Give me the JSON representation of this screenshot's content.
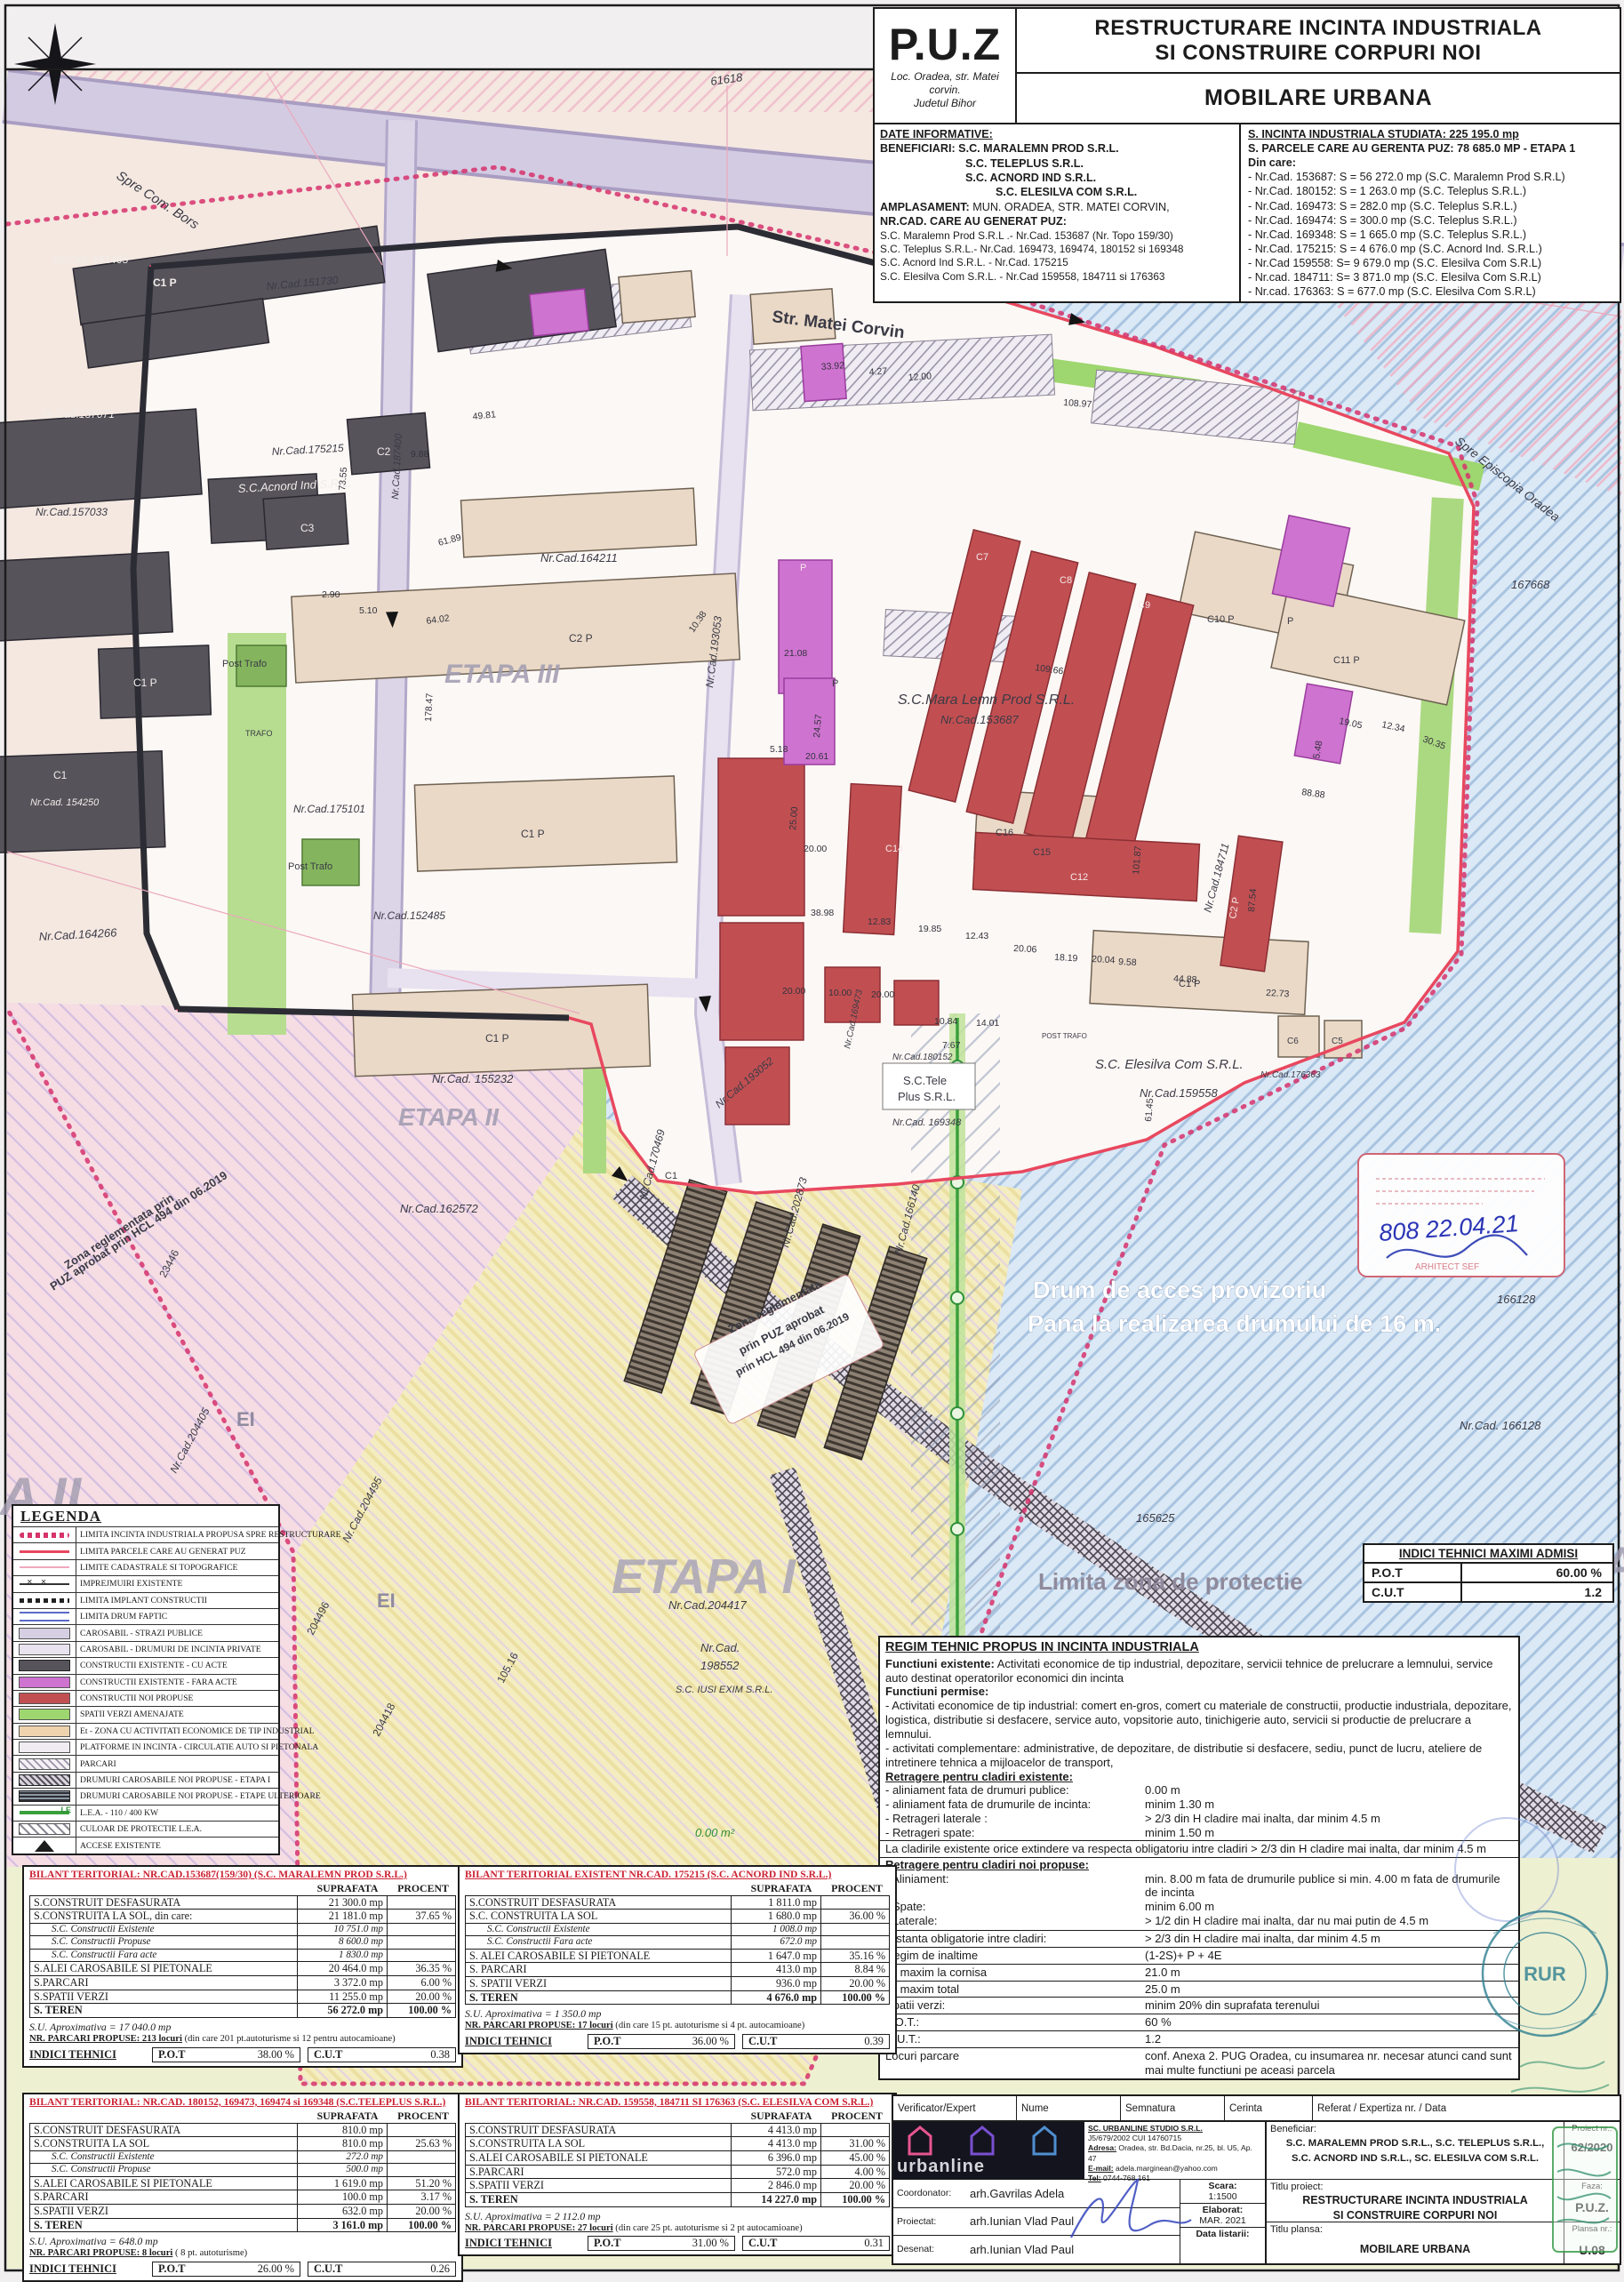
{
  "header": {
    "puz": "P.U.Z",
    "loc1": "Loc. Oradea, str. Matei corvin.",
    "loc2": "Judetul Bihor",
    "title1": "RESTRUCTURARE INCINTA INDUSTRIALA",
    "title2": "SI CONSTRUIRE CORPURI NOI",
    "subtitle": "MOBILARE URBANA",
    "di_label": "DATE INFORMATIVE:",
    "ben_label": "BENEFICIARI:",
    "ben1": "S.C. MARALEMN PROD S.R.L.",
    "ben2": "S.C. TELEPLUS S.R.L.",
    "ben3": "S.C. ACNORD IND S.R.L.",
    "ben4": "S.C. ELESILVA COM S.R.L.",
    "ampl_label": "AMPLASAMENT:",
    "ampl": " MUN. ORADEA, STR. MATEI CORVIN,",
    "nrcad_label": "NR.CAD. CARE AU GENERAT PUZ:",
    "cad1": "S.C. Maralemn Prod S.R.L .- Nr.Cad. 153687 (Nr. Topo 159/30)",
    "cad2": "S.C. Teleplus S.R.L.- Nr.Cad. 169473, 169474, 180152 si 169348",
    "cad3": "S.C. Acnord Ind S.R.L. - Nr.Cad. 175215",
    "cad4": "S.C. Elesilva Com S.R.L. - Nr.Cad  159558, 184711 si 176363",
    "s1": "S. INCINTA INDUSTRIALA STUDIATA: 225 195.0 mp",
    "s2": "S. PARCELE CARE AU GERENTA PUZ: 78 685.0 MP - ETAPA 1",
    "s3": "Din care:",
    "slines": [
      "- Nr.Cad. 153687: S = 56 272.0 mp (S.C. Maralemn Prod S.R.L)",
      "- Nr.Cad. 180152: S =  1 263.0 mp (S.C. Teleplus S.R.L.)",
      "- Nr.Cad. 169473: S =     282.0 mp (S.C. Teleplus S.R.L.)",
      "- Nr.Cad. 169474: S =     300.0 mp (S.C. Teleplus S.R.L.)",
      "- Nr.Cad. 169348: S =  1 665.0 mp (S.C. Teleplus S.R.L.)",
      "- Nr.Cad. 175215: S =  4 676.0 mp (S.C. Acnord Ind. S.R.L.)",
      "- Nr.Cad  159558:  S=  9 679.0 mp (S.C. Elesilva Com S.R.L)",
      "- Nr.cad.  184711:  S=  3 871.0 mp (S.C. Elesilva Com S.R.L)",
      "- Nr.cad.  176363:  S =    677.0 mp (S.C. Elesilva Com S.R.L)"
    ]
  },
  "legend": {
    "title": "LEGENDA",
    "items": [
      "LIMITA INCINTA INDUSTRIALA PROPUSA SPRE RESTRUCTURARE",
      "LIMITA PARCELE CARE AU GENERAT PUZ",
      "LIMITE CADASTRALE SI TOPOGRAFICE",
      "IMPREJMUIRI EXISTENTE",
      "LIMITA IMPLANT CONSTRUCTII",
      "LIMITA DRUM FAPTIC",
      "CAROSABIL - STRAZI PUBLICE",
      "CAROSABIL - DRUMURI DE INCINTA PRIVATE",
      "CONSTRUCTII EXISTENTE - CU ACTE",
      "CONSTRUCTII EXISTENTE - FARA ACTE",
      "CONSTRUCTII NOI PROPUSE",
      "SPATII VERZI AMENAJATE",
      "Et - ZONA CU ACTIVITATI ECONOMICE DE TIP INDUSTRIAL",
      "PLATFORME IN INCINTA - CIRCULATIE AUTO SI PIETONALA",
      "PARCARI",
      "DRUMURI CAROSABILE NOI PROPUSE - ETAPA I",
      "DRUMURI CAROSABILE NOI PROPUSE - ETAPE ULTERIOARE",
      "L.E.A. - 110 / 400 KW",
      "CULOAR DE PROTECTIE L.E.A.",
      "ACCESE EXISTENTE"
    ]
  },
  "indici_maximi": {
    "title": "INDICI TEHNICI MAXIMI ADMISI",
    "pot_label": "P.O.T",
    "pot": "60.00 %",
    "cut_label": "C.U.T",
    "cut": "1.2"
  },
  "regim": {
    "title": "REGIM TEHNIC PROPUS IN INCINTA INDUSTRIALA",
    "fe_bold": "Functiuni existente:",
    "fe_text": " Activitati economice de tip industrial, depozitare, servicii tehnice de prelucrare a lemnului, service auto destinat operatorilor economici din incinta",
    "fp": "Functiuni permise:",
    "b1": "- Activitati economice de tip industrial: comert en-gros, comert cu materiale de constructii, productie industriala, depozitare, logistica, distributie si desfacere, service auto, vopsitorie auto, tinichigerie auto, servicii  si productie de prelucrare a lemnului.",
    "b2": "- activitati complementare: administrative, de depozitare, de distributie si desfacere, sediu, punct de lucru, ateliere de intretinere tehnica a mijloacelor de transport,",
    "re_head": "Retragere pentru cladiri existente:",
    "re_rows": [
      {
        "l": "- aliniament fata de drumuri publice:",
        "v": "0.00 m"
      },
      {
        "l": "- aliniament fata de drumurile de incinta:",
        "v": "minim 1.30 m"
      },
      {
        "l": "- Retrageri laterale :",
        "v": "> 2/3 din H cladire mai inalta, dar minim 4.5 m"
      },
      {
        "l": "- Retrageri spate:",
        "v": "minim 1.50 m"
      }
    ],
    "extindere": "La cladirile existente orice extindere va respecta obligatoriu intre cladiri > 2/3 din H cladire mai inalta, dar minim 4.5 m",
    "rn_head": "Retragere pentru cladiri noi propuse:",
    "rn_rows": [
      {
        "l": "- Aliniament:",
        "v": "min. 8.00 m fata de drumurile publice si min. 4.00 m fata de drumurile de incinta"
      },
      {
        "l": "- Spate:",
        "v": "minim 6.00 m"
      },
      {
        "l": "- Laterale:",
        "v": "> 1/2 din H cladire mai inalta, dar nu mai putin de 4.5 m"
      }
    ],
    "table_rows": [
      {
        "l": "Distanta obligatorie intre cladiri:",
        "v": "> 2/3 din H cladire mai inalta, dar minim 4.5 m"
      },
      {
        "l": "Regim de inaltime",
        "v": "(1-2S)+ P + 4E"
      },
      {
        "l": "H. maxim la cornisa",
        "v": "21.0 m"
      },
      {
        "l": "H. maxim total",
        "v": "25.0 m"
      },
      {
        "l": "Spatii verzi:",
        "v": "minim 20% din suprafata terenului"
      },
      {
        "l": "P.O.T.:",
        "v": "60 %"
      },
      {
        "l": "C.U.T.:",
        "v": "1.2"
      },
      {
        "l": "Locuri parcare",
        "v": "conf. Anexa 2. PUG Oradea, cu insumarea nr. necesar atunci cand sunt mai multe functiuni pe aceasi parcela"
      }
    ]
  },
  "b1": {
    "title": "BILANT TERITORIAL: NR.CAD.153687(159/30) (S.C. MARALEMN PROD S.R.L.)",
    "col_s": "SUPRAFATA",
    "col_p": "PROCENT",
    "rows": [
      {
        "l": "S.CONSTRUIT DESFASURATA",
        "s": "21 300.0 mp",
        "p": ""
      },
      {
        "l": "S.CONSTRUITA LA SOL, din care:",
        "s": "21 181.0 mp",
        "p": "37.65 %"
      },
      {
        "l": "S.C. Constructii Existente",
        "s": "10 751.0 mp",
        "p": ""
      },
      {
        "l": "S.C. Constructii Propuse",
        "s": "8 600.0 mp",
        "p": ""
      },
      {
        "l": "S.C. Constructii Fara acte",
        "s": "1 830.0 mp",
        "p": ""
      },
      {
        "l": "S.ALEI CAROSABILE SI PIETONALE",
        "s": "20 464.0 mp",
        "p": "36.35 %"
      },
      {
        "l": "S.PARCARI",
        "s": "3 372.0 mp",
        "p": "6.00 %"
      },
      {
        "l": "S.SPATII VERZI",
        "s": "11 255.0 mp",
        "p": "20.00 %"
      },
      {
        "l": "S. TEREN",
        "s": "56 272.0 mp",
        "p": "100.00 %"
      }
    ],
    "su": "S.U. Aproximativa = 17 040.0 mp",
    "parc_b": "NR. PARCARI PROPUSE: 213 locuri",
    "parc_r": " (din care 201 pt.autoturisme si 12 pentru autocamioane)",
    "ind": "INDICI TEHNICI",
    "potl": "P.O.T",
    "pot": "38.00 %",
    "cutl": "C.U.T",
    "cut": "0.38"
  },
  "b2": {
    "title": "BILANT TERITORIAL EXISTENT NR.CAD. 175215 (S.C. ACNORD IND S.R.L.)",
    "col_s": "SUPRAFATA",
    "col_p": "PROCENT",
    "rows": [
      {
        "l": "S.CONSTRUIT DESFASURATA",
        "s": "1 811.0 mp",
        "p": ""
      },
      {
        "l": "S.C. CONSTRUITA LA SOL",
        "s": "1 680.0 mp",
        "p": "36.00 %"
      },
      {
        "l": "S.C. Constructii Existente",
        "s": "1 008.0 mp",
        "p": ""
      },
      {
        "l": "S.C. Constructii Fara acte",
        "s": "672.0 mp",
        "p": ""
      },
      {
        "l": "S. ALEI CAROSABILE SI PIETONALE",
        "s": "1 647.0 mp",
        "p": "35.16 %"
      },
      {
        "l": "S. PARCARI",
        "s": "413.0 mp",
        "p": "8.84 %"
      },
      {
        "l": "S. SPATII VERZI",
        "s": "936.0 mp",
        "p": "20.00 %"
      },
      {
        "l": "S. TEREN",
        "s": "4 676.0 mp",
        "p": "100.00 %"
      }
    ],
    "su": "S.U. Aproximativa = 1 350.0 mp",
    "parc_b": "NR. PARCARI PROPUSE: 17 locuri",
    "parc_r": " (din care 15 pt. autoturisme si 4 pt. autocamioane)",
    "ind": "INDICI TEHNICI",
    "potl": "P.O.T",
    "pot": "36.00 %",
    "cutl": "C.U.T",
    "cut": "0.39"
  },
  "b3": {
    "title": "BILANT TERITORIAL: NR.CAD. 180152, 169473, 169474 si 169348 (S.C.TELEPLUS S.R.L.)",
    "col_s": "SUPRAFATA",
    "col_p": "PROCENT",
    "rows": [
      {
        "l": "S.CONSTRUIT DESFASURATA",
        "s": "810.0 mp",
        "p": ""
      },
      {
        "l": "S.CONSTRUITA LA SOL",
        "s": "810.0 mp",
        "p": "25.63 %"
      },
      {
        "l": "S.C. Constructii Existente",
        "s": "272.0 mp",
        "p": ""
      },
      {
        "l": "S.C. Constructii Propuse",
        "s": "500.0 mp",
        "p": ""
      },
      {
        "l": "S.ALEI CAROSABILE SI PIETONALE",
        "s": "1 619.0 mp",
        "p": "51.20 %"
      },
      {
        "l": "S.PARCARI",
        "s": "100.0 mp",
        "p": "3.17 %"
      },
      {
        "l": "S.SPATII VERZI",
        "s": "632.0 mp",
        "p": "20.00 %"
      },
      {
        "l": "S. TEREN",
        "s": "3 161.0 mp",
        "p": "100.00 %"
      }
    ],
    "su": "S.U. Aproximativa = 648.0 mp",
    "parc_b": "NR. PARCARI PROPUSE: 8 locuri",
    "parc_r": " ( 8 pt. autoturisme)",
    "ind": "INDICI TEHNICI",
    "potl": "P.O.T",
    "pot": "26.00 %",
    "cutl": "C.U.T",
    "cut": "0.26"
  },
  "b4": {
    "title": "BILANT TERITORIAL: NR.CAD. 159558, 184711 SI 176363 (S.C. ELESILVA COM S.R.L.)",
    "col_s": "SUPRAFATA",
    "col_p": "PROCENT",
    "rows": [
      {
        "l": "S.CONSTRUIT DESFASURATA",
        "s": "4 413.0 mp",
        "p": ""
      },
      {
        "l": "S.CONSTRUITA LA SOL",
        "s": "4 413.0 mp",
        "p": "31.00 %"
      },
      {
        "l": "S.ALEI CAROSABILE SI PIETONALE",
        "s": "6 396.0 mp",
        "p": "45.00 %"
      },
      {
        "l": "S.PARCARI",
        "s": "572.0 mp",
        "p": "4.00 %"
      },
      {
        "l": "S.SPATII VERZI",
        "s": "2 846.0 mp",
        "p": "20.00 %"
      },
      {
        "l": "S. TEREN",
        "s": "14 227.0 mp",
        "p": "100.00 %"
      }
    ],
    "su": "S.U. Aproximativa = 2 112.0 mp",
    "parc_b": "NR. PARCARI PROPUSE: 27 locuri",
    "parc_r": " (din care 25 pt. autoturisme si 2 pt autocamioane)",
    "ind": "INDICI TEHNICI",
    "potl": "P.O.T",
    "pot": "31.00 %",
    "cutl": "C.U.T",
    "cut": "0.31"
  },
  "tb": {
    "ver": [
      "Verificator/Expert",
      "Nume",
      "Semnatura",
      "Cerinta",
      "Referat / Expertiza nr. / Data"
    ],
    "logo": "urbanline",
    "co_name": "SC. URBANLINE STUDIO S.R.L.",
    "co_reg": "J5/679/2002    CUI 14760715",
    "co_adr_l": "Adresa:",
    "co_adr": " Oradea, str. Bd.Dacia, nr.25, bl. U5, Ap. 47",
    "co_mail_l": "E-mail:",
    "co_mail": " adela.marginean@yahoo.com",
    "co_tel_l": "Tel:",
    "co_tel": " 0744-768.161",
    "r1l": "Coordonator:",
    "r1v": "arh.Gavrilas Adela",
    "r2l": "Proiectat:",
    "r2v": "arh.Iunian Vlad Paul",
    "r3l": "Desenat:",
    "r3v": "arh.Iunian Vlad Paul",
    "scara_l": "Scara:",
    "scara": "1:1500",
    "elab_l": "Elaborat:",
    "elab": "MAR. 2021",
    "datal": "Data listarii:",
    "ben_l": "Beneficiar:",
    "ben1": "S.C. MARALEMN PROD S.R.L.,    S.C. TELEPLUS S.R.L.,",
    "ben2": "S.C. ACNORD IND S.R.L.,    SC. ELESILVA COM S.R.L.",
    "tp_l": "Titlu proiect:",
    "tp1": "RESTRUCTURARE INCINTA INDUSTRIALA",
    "tp2": "SI CONSTRUIRE CORPURI NOI",
    "tpl_l": "Titlu plansa:",
    "tpl": "MOBILARE URBANA",
    "prj_l": "Proiect nr.:",
    "prj": "62/2020",
    "faza_l": "Faza:",
    "faza": "P.U.Z.",
    "plansa_l": "Plansa nr.:",
    "plansa": "U.08"
  },
  "stamps": {
    "rur": "RUR"
  },
  "map": {
    "labels": [
      "Spre Com. Bors",
      "Str. Matei Corvin",
      "Spre Episcopia Oradea",
      "61618",
      "167668",
      "Nr.Cad. 161465",
      "Nr.Cad.151730",
      "Nr.Cad.157071",
      "Nr.Cad.157033",
      "S.C.Acnord Ind S.R.L.",
      "Nr.Cad.175215",
      "Nr.Cad.164211",
      "ETAPA III",
      "S.C.Mara Lemn Prod S.R.L.",
      "Nr.Cad.153687",
      "Post Trafo",
      "TRAFO",
      "Post Trafo",
      "Nr.Cad.175101",
      "Nr.Cad.152485",
      "Nr.Cad.164266",
      "Nr.Cad. 155232",
      "ETAPA II",
      "Nr.Cad.162572",
      "Zona reglementata prin",
      "PUZ aprobat prin HCL 494 din 06.2019",
      "Zona reglementata",
      "prin PUZ aprobat",
      "prin HCL 494 din 06.2019",
      "Drum de acces provizoriu",
      "Pana la realizarea drumului de 16 m.",
      "Nr.Cad. 166128",
      "166128",
      "165625",
      "ETA",
      "A II",
      "EI",
      "EI",
      "ETAPA I",
      "Nr.Cad.204417",
      "Nr.Cad.",
      "198552",
      "S.C. IUSI EXIM S.R.L.",
      "204496",
      "204418",
      "105.16",
      "16.01",
      "Nr.Cad.204405",
      "Nr.Cad.204495",
      "23446",
      "Nr.Cad.170469",
      "Nr.Cad.202873",
      "Nr.Cad.166140",
      "Nr.Cad.193053",
      "Nr.Cad.193052",
      "Nr.Cad.169473",
      "Nr.Cad.184711",
      "Nr.Cad.180152",
      "S.C.Tele",
      "Plus S.R.L.",
      "Nr.Cad. 169348",
      "S.C. Elesilva Com S.R.L.",
      "Nr.Cad.159558",
      "POST TRAFO",
      "Limita zona de protectie",
      "0.00 m²",
      "808  22.04.21",
      "ARHITECT SEF",
      "C1 P",
      "C2",
      "C3",
      "C1 P",
      "C1",
      "Nr.Cad. 154250",
      "C2 P",
      "C1 P",
      "C1 P",
      "C7",
      "C8",
      "C9",
      "C10 P",
      "C11 P",
      "C14",
      "C12",
      "C16",
      "C15",
      "C2 P",
      "C1 P",
      "C5",
      "C6",
      "C1",
      "P",
      "P",
      "P",
      "Nr.Cad.187400",
      "Nr.Cad.176363"
    ],
    "dims": [
      "33.92",
      "4.27",
      "12.00",
      "108.97",
      "49.81",
      "9.88",
      "73.55",
      "61.89",
      "64.02",
      "178.47",
      "2.90",
      "5.10",
      "10.38",
      "21.08",
      "24.57",
      "20.61",
      "5.18",
      "109.66",
      "101.87",
      "87.54",
      "19.05",
      "12.34",
      "30.35",
      "5.48",
      "88.88",
      "38.98",
      "12.83",
      "19.85",
      "12.43",
      "20.06",
      "18.19",
      "44.88",
      "22.73",
      "61.45",
      "20.00",
      "25.00",
      "20.00",
      "10.00",
      "20.00",
      "10.84",
      "14.01",
      "7.67",
      "20.04",
      "9.58"
    ]
  }
}
